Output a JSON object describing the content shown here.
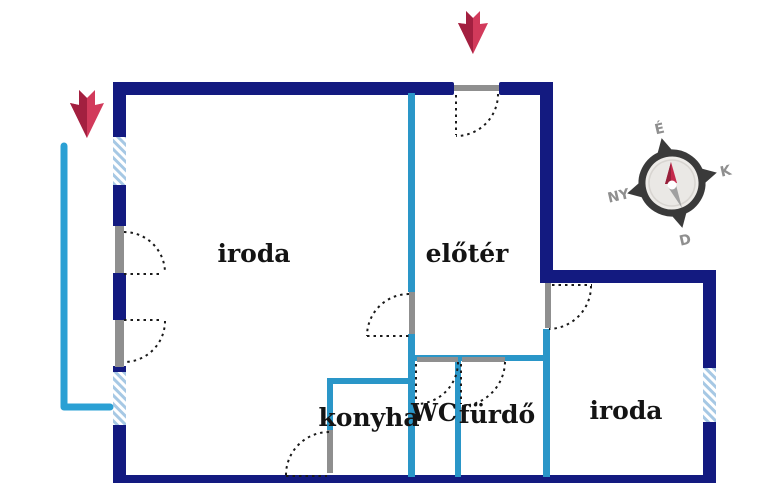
{
  "image_type": "apartment floor plan",
  "rooms": [
    {
      "id": "iroda-left",
      "label": "iroda"
    },
    {
      "id": "eloter",
      "label": "előtér"
    },
    {
      "id": "konyha",
      "label": "konyha"
    },
    {
      "id": "wc",
      "label": "WC"
    },
    {
      "id": "furdo",
      "label": "fürdő"
    },
    {
      "id": "iroda-right",
      "label": "iroda"
    }
  ],
  "compass": {
    "north_label": "É",
    "east_label": "K",
    "south_label": "D",
    "west_label": "NY"
  },
  "entrances": {
    "arrow_count": 2,
    "positions": [
      "left exterior wall",
      "top wall of előtér"
    ]
  },
  "colors": {
    "exterior_wall": "#131a80",
    "interior_wall": "#2a96c8",
    "window_hatch": "#a6c8e4",
    "door_closed_bar": "#8f8f8f",
    "door_swing_dots": "#1a1a1a",
    "entrance_arrow": "#d23a5b",
    "entrance_arrow_shade": "#a32040",
    "compass_ring": "#3a3a3a",
    "compass_needle_north": "#c42a4c",
    "compass_needle_south": "#a0a0a0",
    "background": "#ffffff"
  }
}
